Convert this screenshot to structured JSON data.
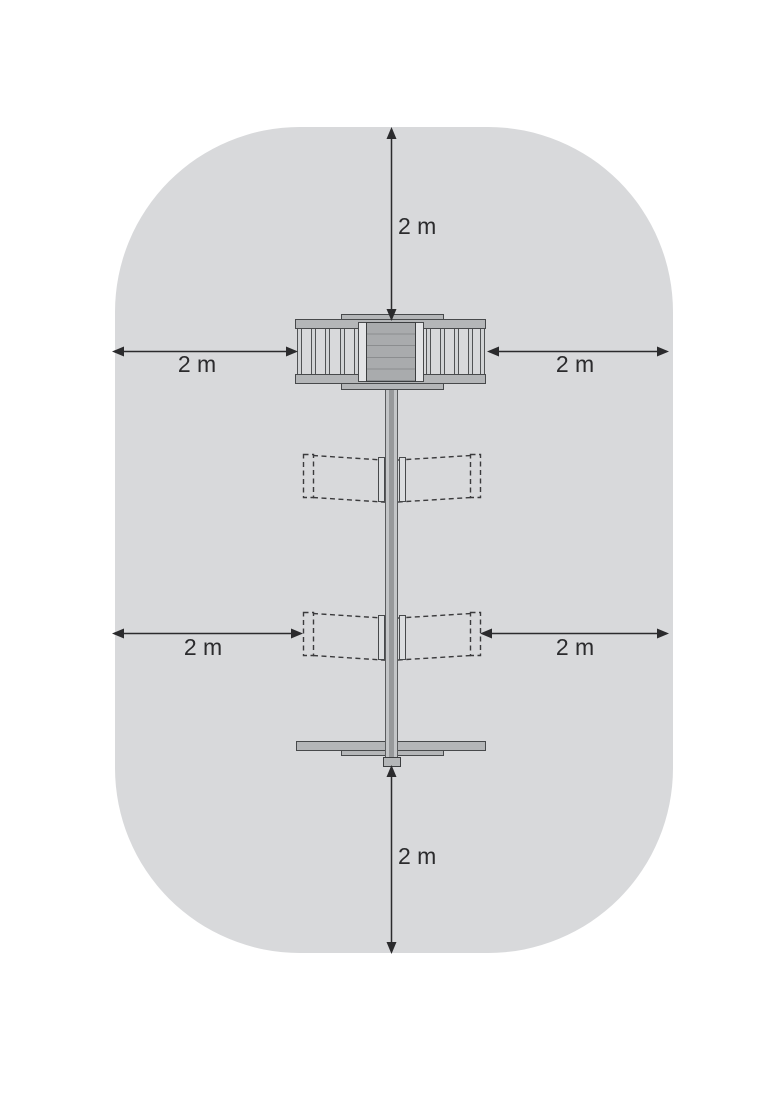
{
  "diagram": {
    "subject": "playground-equipment-top-view-with-minimum-clearance-zone",
    "zone_fill": "#d8d9db",
    "equipment_fill": "#b4b6b8",
    "outline_color": "#47494b",
    "dimension_color": "#2b2b2d"
  },
  "dimensions": {
    "top": {
      "label": "2 m",
      "value": 2,
      "unit": "m"
    },
    "bottom": {
      "label": "2 m",
      "value": 2,
      "unit": "m"
    },
    "left_upper": {
      "label": "2 m",
      "value": 2,
      "unit": "m"
    },
    "right_upper": {
      "label": "2 m",
      "value": 2,
      "unit": "m"
    },
    "left_lower": {
      "label": "2 m",
      "value": 2,
      "unit": "m"
    },
    "right_lower": {
      "label": "2 m",
      "value": 2,
      "unit": "m"
    }
  }
}
